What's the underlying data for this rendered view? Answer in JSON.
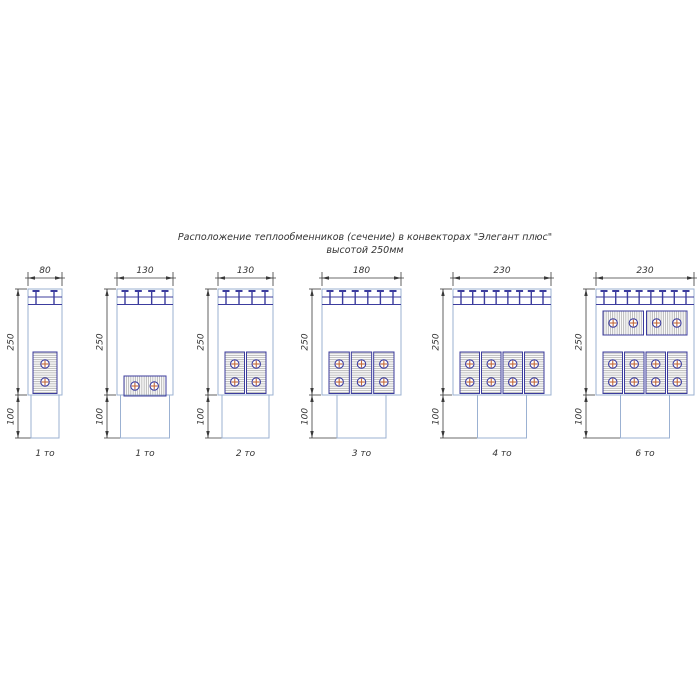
{
  "title": {
    "line1": "Расположение теплообменников (сечение) в конвекторах \"Элегант плюс\"",
    "line2": "высотой 250мм"
  },
  "colors": {
    "casing": "#9bb1d2",
    "navy": "#3c3c9e",
    "hatch": "#9a9a9a",
    "dimension": "#3a3a3a",
    "tube_cross": "#c2693a",
    "text": "#333333"
  },
  "diagrams": [
    {
      "name": "convector-80-1",
      "width_label": "80",
      "upper_height_label": "250",
      "lower_height_label": "100",
      "count_label": "1 то",
      "clips": 2,
      "top_blocks": {
        "count": 0,
        "orientation": "horizontal",
        "tubes_per_block": 0
      },
      "bottom_blocks": {
        "count": 1,
        "orientation": "vertical",
        "tubes_per_block": 2
      }
    },
    {
      "name": "convector-130-1",
      "width_label": "130",
      "upper_height_label": "250",
      "lower_height_label": "100",
      "count_label": "1 то",
      "clips": 4,
      "top_blocks": {
        "count": 0,
        "orientation": "horizontal",
        "tubes_per_block": 0
      },
      "bottom_blocks": {
        "count": 1,
        "orientation": "horizontal",
        "tubes_per_block": 2
      }
    },
    {
      "name": "convector-130-2",
      "width_label": "130",
      "upper_height_label": "250",
      "lower_height_label": "100",
      "count_label": "2 то",
      "clips": 4,
      "top_blocks": {
        "count": 0,
        "orientation": "horizontal",
        "tubes_per_block": 0
      },
      "bottom_blocks": {
        "count": 2,
        "orientation": "vertical",
        "tubes_per_block": 2
      }
    },
    {
      "name": "convector-180-3",
      "width_label": "180",
      "upper_height_label": "250",
      "lower_height_label": "100",
      "count_label": "3 то",
      "clips": 6,
      "top_blocks": {
        "count": 0,
        "orientation": "horizontal",
        "tubes_per_block": 0
      },
      "bottom_blocks": {
        "count": 3,
        "orientation": "vertical",
        "tubes_per_block": 2
      }
    },
    {
      "name": "convector-230-4",
      "width_label": "230",
      "upper_height_label": "250",
      "lower_height_label": "100",
      "count_label": "4 то",
      "clips": 8,
      "top_blocks": {
        "count": 0,
        "orientation": "horizontal",
        "tubes_per_block": 0
      },
      "bottom_blocks": {
        "count": 4,
        "orientation": "vertical",
        "tubes_per_block": 2
      }
    },
    {
      "name": "convector-230-6",
      "width_label": "230",
      "upper_height_label": "250",
      "lower_height_label": "100",
      "count_label": "6 то",
      "clips": 8,
      "top_blocks": {
        "count": 2,
        "orientation": "horizontal",
        "tubes_per_block": 2
      },
      "bottom_blocks": {
        "count": 4,
        "orientation": "vertical",
        "tubes_per_block": 2
      }
    }
  ]
}
